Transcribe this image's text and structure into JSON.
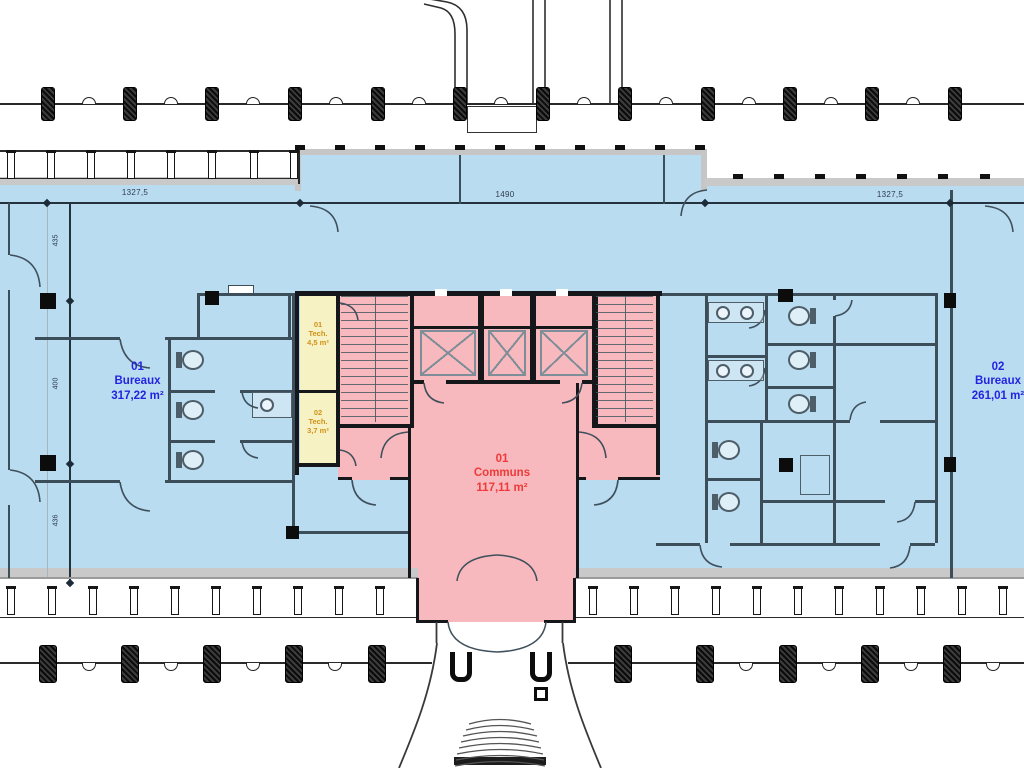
{
  "plan": {
    "type": "architectural-floor-plan",
    "rooms": {
      "bureaux1": {
        "code": "01",
        "name": "Bureaux",
        "area": "317,22 m²"
      },
      "bureaux2": {
        "code": "02",
        "name": "Bureaux",
        "area": "261,01 m²"
      },
      "communs": {
        "code": "01",
        "name": "Communs",
        "area": "117,11 m²"
      },
      "tech1": {
        "code": "01",
        "name": "Tech.",
        "area": "4,5 m²"
      },
      "tech2": {
        "code": "02",
        "name": "Tech.",
        "area": "3,7 m²"
      }
    },
    "dimensions": {
      "top_left": "1327,5",
      "top_center": "1490",
      "top_right": "1327,5",
      "left_top": "435",
      "left_middle": "400",
      "left_bottom": "436"
    },
    "colors": {
      "office_zone": "#b9dcf0",
      "common_zone": "#f7b9bd",
      "tech_zone": "#f6f2c3",
      "office_label": "#2323e0",
      "common_label": "#ee3a3a",
      "tech_label": "#d2921a",
      "wall": "#3c4e59",
      "core_wall": "#15171a",
      "dimension_text": "#2e3b4e"
    }
  }
}
